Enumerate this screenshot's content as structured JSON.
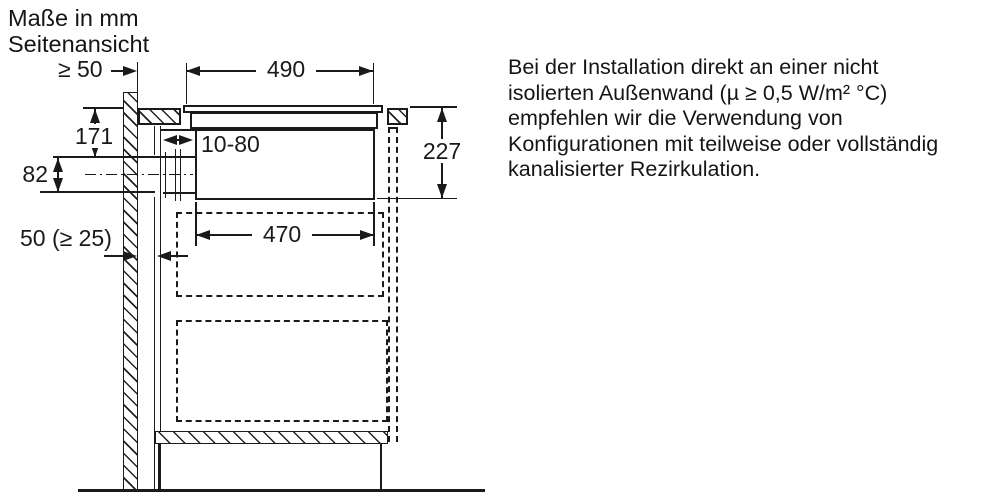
{
  "title": {
    "units": "Maße in mm",
    "view": "Seitenansicht"
  },
  "note": {
    "lines": [
      "Bei der Installation direkt an einer nicht",
      "isolierten Außenwand (µ ≥ 0,5 W/m² °C)",
      "empfehlen wir die Verwendung von",
      "Konfigurationen mit teilweise oder vollständig",
      "kanalisierter Rezirkulation."
    ]
  },
  "dimensions": {
    "min_wall_thickness": "≥ 50",
    "hob_cutout_width": "490",
    "counter_to_duct": "171",
    "duct_height": "82",
    "duct_slide_range": "10-80",
    "unit_height": "227",
    "rear_clearance": "50 (≥ 25)",
    "box_width": "470"
  },
  "colors": {
    "line": "#1a1a1a",
    "background": "#ffffff"
  }
}
